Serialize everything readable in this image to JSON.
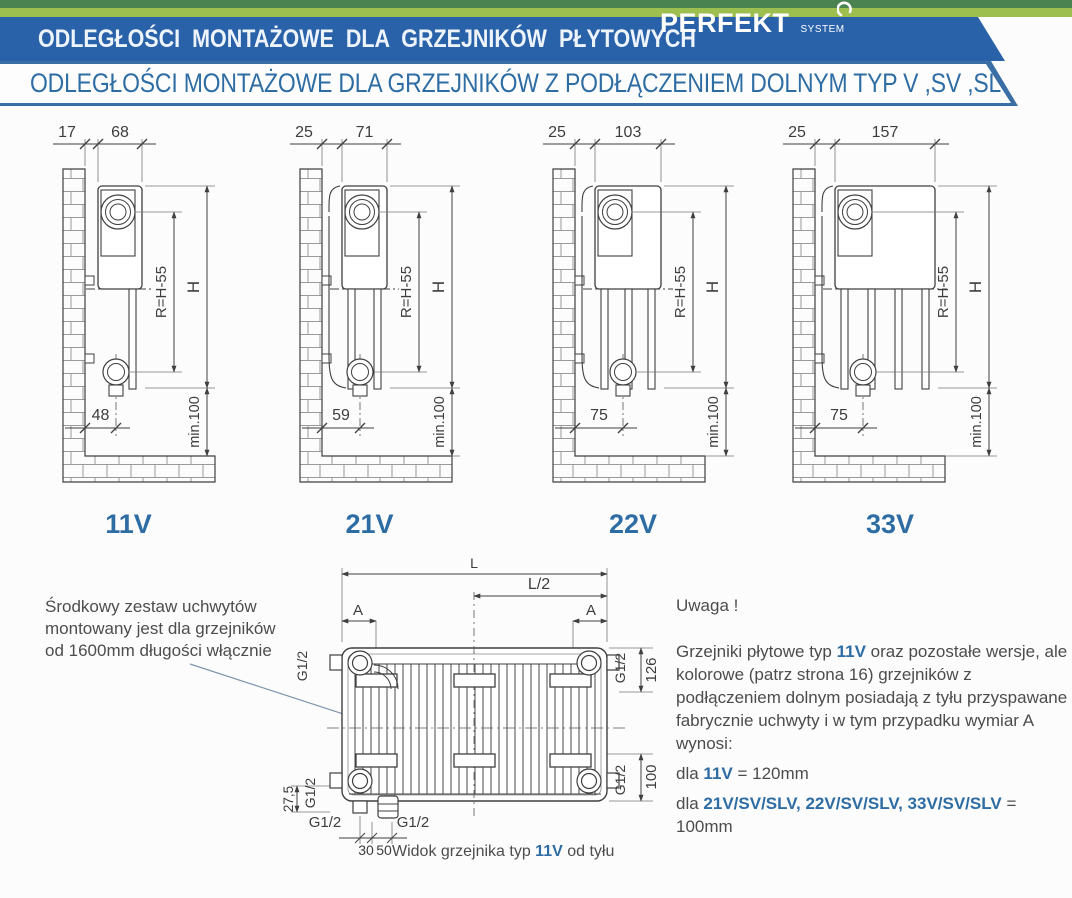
{
  "header": {
    "title": "ODLEGŁOŚCI MONTAŻOWE DLA GRZEJNIKÓW PŁYTOWYCH",
    "logo_main": "PERFEKT",
    "logo_sub": "SYSTEM",
    "subtitle": "ODLEGŁOŚCI MONTAŻOWE DLA GRZEJNIKÓW Z PODŁĄCZENIEM DOLNYM TYP V ,SV ,SLV"
  },
  "colors": {
    "banner_blue": "#2a62a9",
    "strip_dark_green": "#4a8350",
    "strip_lime": "#9dbf4f",
    "border_blue": "#3a6ea5",
    "subtitle_text": "#2e6da4",
    "accent_blue": "#2e6da4",
    "line": "#3f3f3f",
    "dim_text": "#3d3d3d",
    "note_text": "#4d4d4d",
    "leader": "#7d95ad"
  },
  "diagrams": [
    {
      "label": "11V",
      "wall_gap": "17",
      "depth": "68",
      "radius_dim": "R=H-55",
      "height_dim": "H",
      "bottom_offset": "48",
      "floor_clearance": "min.100"
    },
    {
      "label": "21V",
      "wall_gap": "25",
      "depth": "71",
      "radius_dim": "R=H-55",
      "height_dim": "H",
      "bottom_offset": "59",
      "floor_clearance": "min.100"
    },
    {
      "label": "22V",
      "wall_gap": "25",
      "depth": "103",
      "radius_dim": "R=H-55",
      "height_dim": "H",
      "bottom_offset": "75",
      "floor_clearance": "min.100"
    },
    {
      "label": "33V",
      "wall_gap": "25",
      "depth": "157",
      "radius_dim": "R=H-55",
      "height_dim": "H",
      "bottom_offset": "75",
      "floor_clearance": "min.100"
    }
  ],
  "rear_view": {
    "dim_length": "L",
    "dim_half_length": "L/2",
    "dim_a_left": "A",
    "dim_a_right": "A",
    "thread_top_left": "G1/2",
    "thread_top_right": "G1/2",
    "thread_bottom_left": "G1/2",
    "thread_bottom_right": "G1/2",
    "thread_conn_left": "G1/2",
    "thread_conn_right": "G1/2",
    "dim_top_height": "126",
    "dim_bottom_height": "100",
    "dim_left_offset": "27,5",
    "dim_conn_30": "30",
    "dim_conn_50": "50",
    "caption_prefix": "Widok grzejnika typ ",
    "caption_type": "11V",
    "caption_suffix": " od tyłu"
  },
  "notes": {
    "left_note_lines": [
      "Środkowy zestaw uchwytów",
      "montowany jest dla grzejników",
      "od 1600mm długości włącznie"
    ],
    "warning": "Uwaga !",
    "para_prefix": "Grzejniki płytowe typ ",
    "para_type": "11V",
    "para_suffix": " oraz pozostałe wersje, ale kolorowe (patrz strona 16) grzejników z podłączeniem dolnym posiadają z tyłu przyspawane fabrycznie uchwyty i w tym przypadku wymiar A wynosi:",
    "rule1_prefix": "dla ",
    "rule1_type": "11V",
    "rule1_value": " = 120mm",
    "rule2_prefix": "dla ",
    "rule2_types": "21V/SV/SLV, 22V/SV/SLV, 33V/SV/SLV",
    "rule2_value": " = 100mm"
  }
}
